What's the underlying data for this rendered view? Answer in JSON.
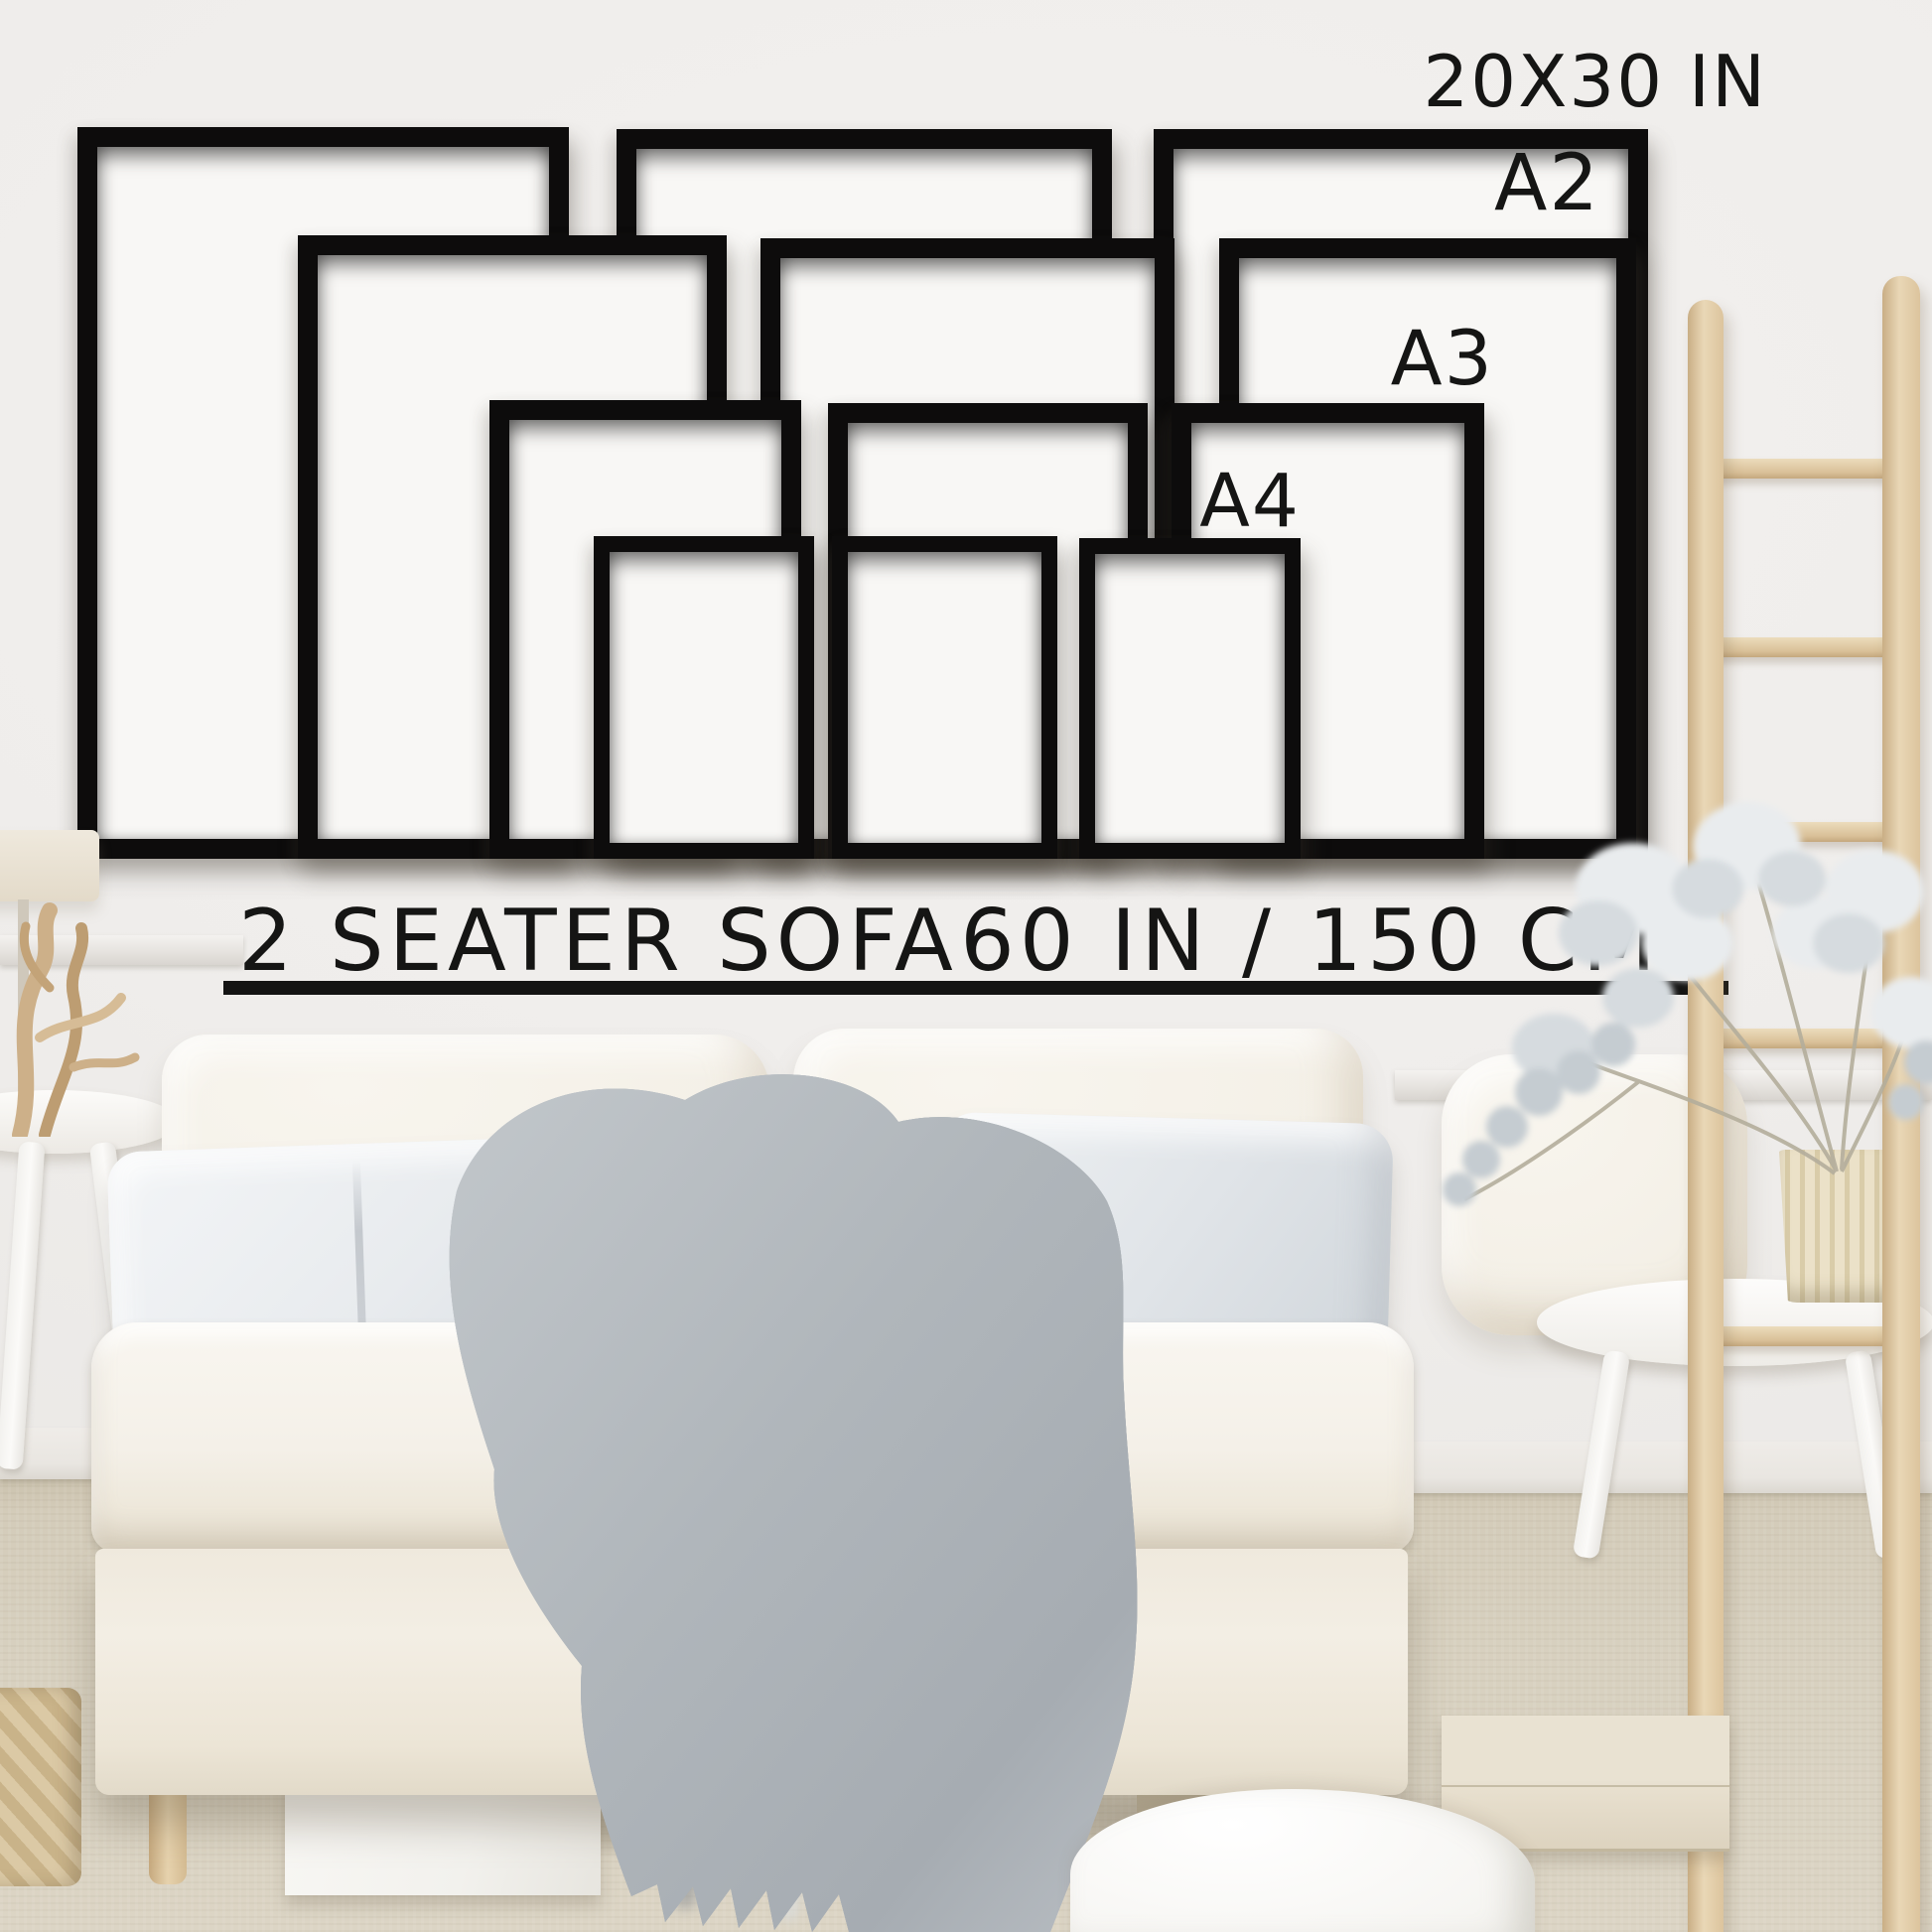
{
  "page": {
    "type": "poster-frame-size-guide-mockup"
  },
  "wall_art": {
    "frame_sizes": [
      {
        "id": "20x30",
        "label": "20X30 IN"
      },
      {
        "id": "a2",
        "label": "A2"
      },
      {
        "id": "a3",
        "label": "A3"
      },
      {
        "id": "a4",
        "label": "A4"
      }
    ]
  },
  "sofa": {
    "label": "2 SEATER SOFA",
    "width_label": "60 IN / 150 CM"
  },
  "colors": {
    "frame_black": "#0d0c0c",
    "text": "#151514",
    "wall": "#f0eeec",
    "carpet": "#d6cebd",
    "sofa_cream": "#f4f0e7",
    "blanket_gray": "#b3b8bd",
    "wood": "#e2cda9"
  }
}
